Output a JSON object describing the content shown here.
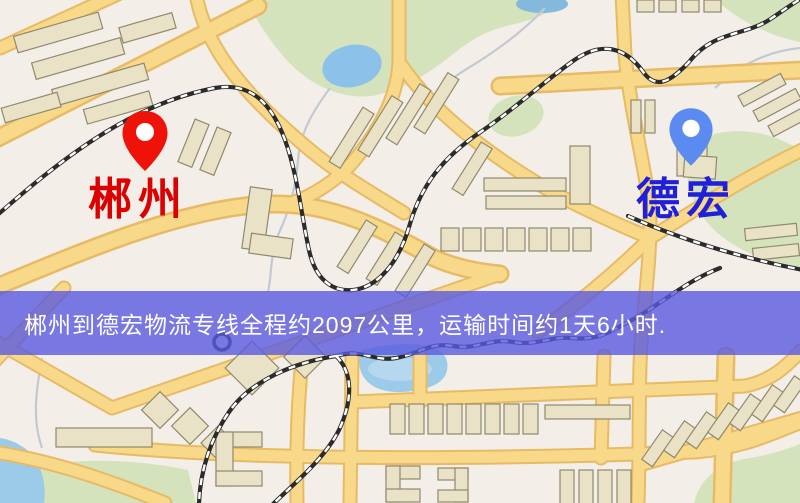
{
  "map": {
    "origin": {
      "name": "郴州"
    },
    "destination": {
      "name": "德宏"
    }
  },
  "banner": {
    "text": "郴州到德宏物流专线全程约2097公里，运输时间约1天6小时.",
    "distance_km": "2097",
    "duration": "1天6小时"
  },
  "colors": {
    "origin_pin": "#ee1208",
    "origin_label": "#dd0000",
    "destination_pin": "#5b8bf0",
    "destination_label": "#2020d8",
    "banner_bg": "#5a5ae0",
    "road": "#f8d98a",
    "water": "#9ccae9",
    "park": "#d5e3bd"
  }
}
